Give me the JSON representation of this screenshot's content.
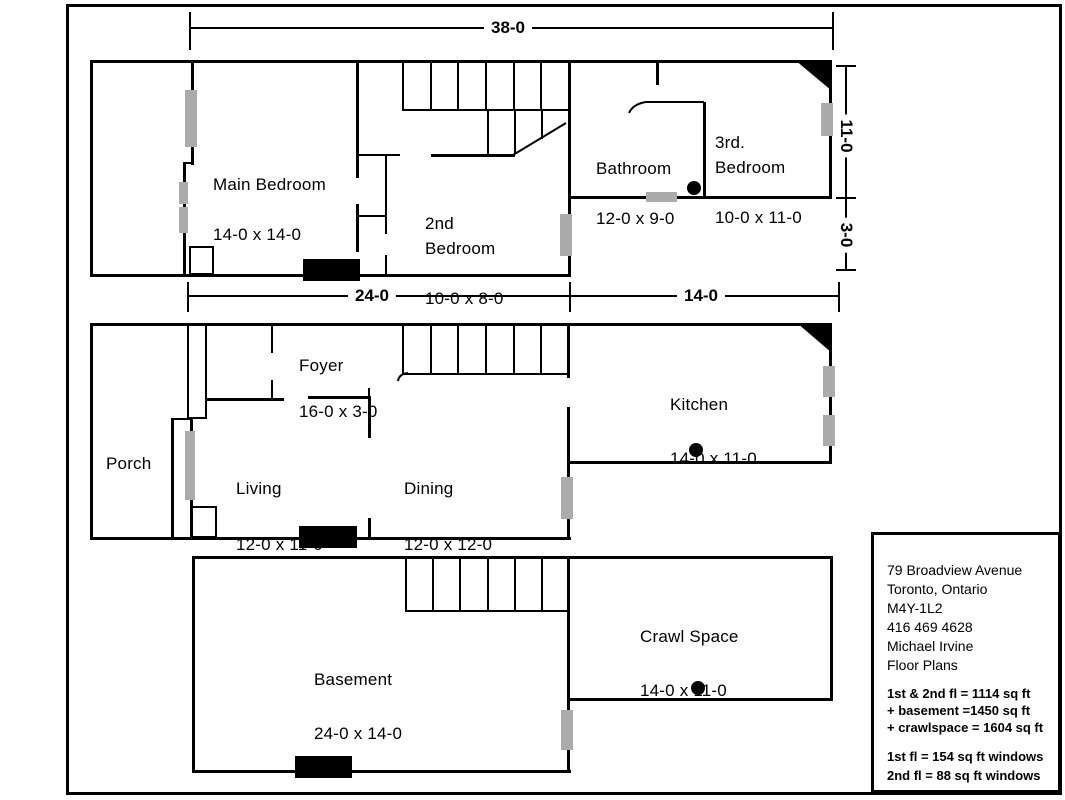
{
  "floors": {
    "second": {
      "main_bedroom": {
        "name": "Main Bedroom",
        "size": "14-0 x 14-0"
      },
      "second_bedroom": {
        "name": "2nd\nBedroom",
        "size": "10-0 x 8-0"
      },
      "bathroom": {
        "name": "Bathroom",
        "size": "12-0 x 9-0"
      },
      "third_bedroom": {
        "name": "3rd.\nBedroom",
        "size": "10-0 x 11-0"
      }
    },
    "first": {
      "foyer": {
        "name": "Foyer",
        "size": "16-0 x 3-0"
      },
      "porch": {
        "name": "Porch"
      },
      "living": {
        "name": "Living",
        "size": "12-0 x 11-0"
      },
      "dining": {
        "name": "Dining",
        "size": "12-0 x 12-0"
      },
      "kitchen": {
        "name": "Kitchen",
        "size": "14-0 x 11-0"
      }
    },
    "basement": {
      "basement": {
        "name": "Basement",
        "size": "24-0 x 14-0"
      },
      "crawl_space": {
        "name": "Crawl Space",
        "size": "14-0 x 11-0"
      }
    }
  },
  "dimensions": {
    "overall_width": "38-0",
    "main_width": "24-0",
    "rear_width": "14-0",
    "rear_depth": "11-0",
    "rear_offset": "3-0"
  },
  "info_box": {
    "address": [
      "79 Broadview Avenue",
      "Toronto, Ontario",
      "M4Y-1L2",
      "416 469 4628",
      "Michael Irvine",
      "Floor Plans"
    ],
    "areas": [
      "1st & 2nd fl = 1114 sq ft",
      "+ basement  =1450 sq ft",
      "+ crawlspace = 1604 sq ft"
    ],
    "windows": [
      "1st fl = 154 sq ft windows",
      "2nd fl = 88 sq ft windows"
    ]
  }
}
